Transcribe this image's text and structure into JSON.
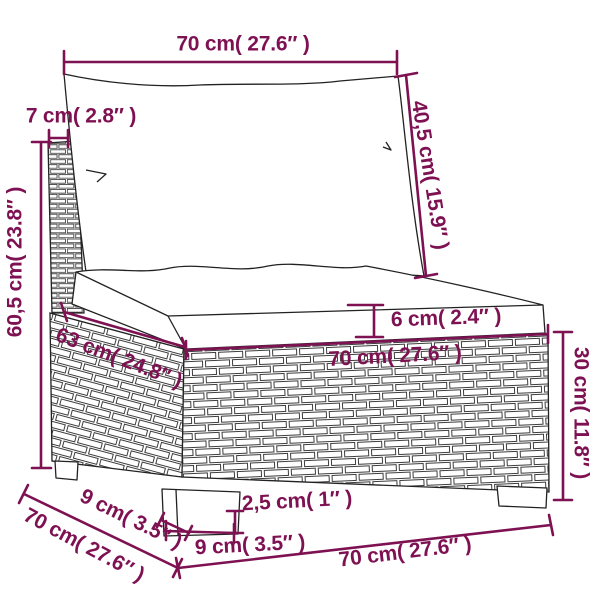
{
  "diagram": {
    "accent_color": "#7e1152",
    "line_color": "#222222",
    "labels": {
      "top_width": "70 cm( 27.6″ )",
      "back_cushion_height": "40,5 cm( 15.9″ )",
      "back_panel_thickness": "7 cm( 2.8″ )",
      "total_height": "60,5 cm( 23.8″ )",
      "seat_depth": "63 cm( 24.8″ )",
      "seat_cushion_thickness": "6 cm( 2.4″ )",
      "seat_front_width": "70 cm( 27.6″ )",
      "base_height": "30 cm( 11.8″ )",
      "foot_height": "2,5 cm( 1″ )",
      "foot_front_width": "9 cm( 3.5″ )",
      "foot_side_depth": "9 cm( 3.5″ )",
      "total_depth": "70 cm( 27.6″ )",
      "total_width": "70 cm( 27.6″ )"
    }
  }
}
